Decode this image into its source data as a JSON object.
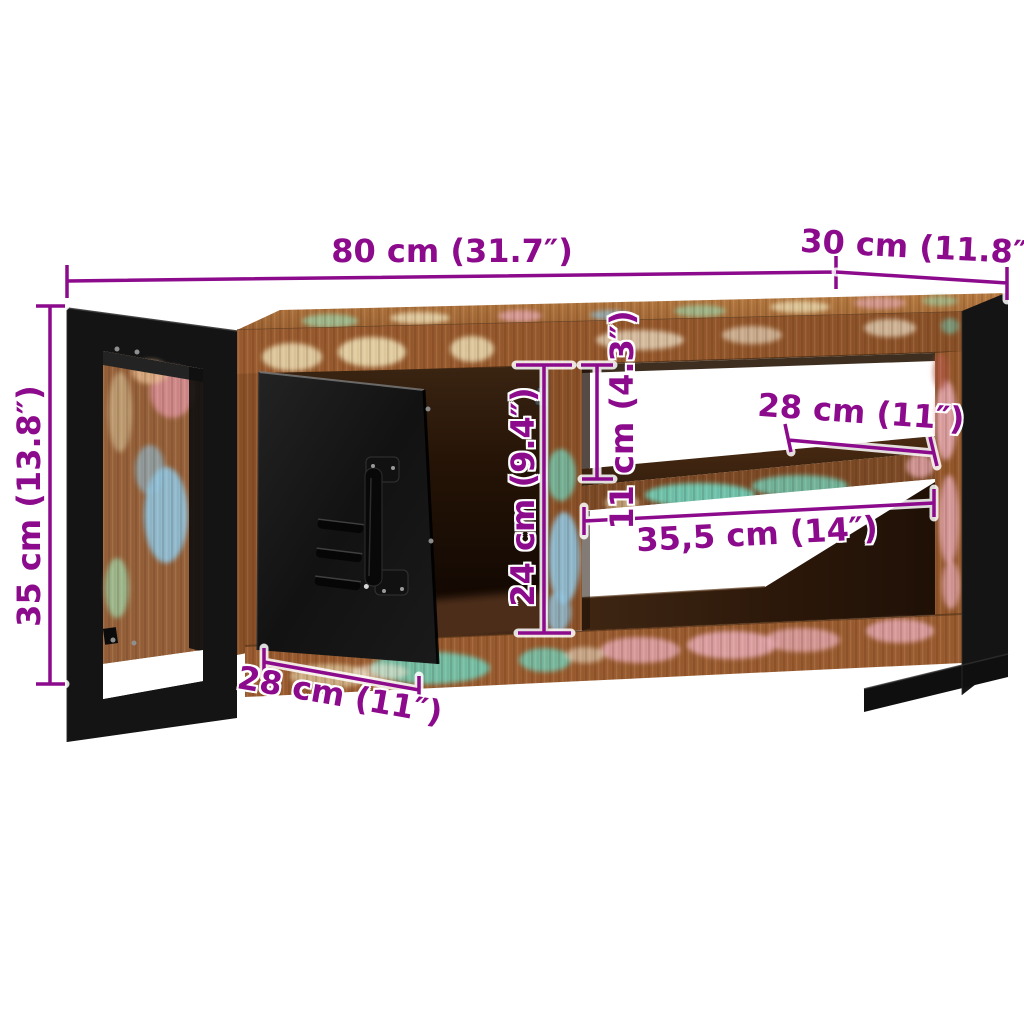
{
  "annotations": {
    "width": "80 cm (31.7″)",
    "depth": "30 cm (11.8″)",
    "height": "35 cm (13.8″)",
    "interior_height": "24 cm (9.4″)",
    "top_shelf_height": "11 cm (4.3″)",
    "shelf_depth": "28 cm (11″)",
    "shelf_width": "35,5 cm (14″)",
    "door_width": "28 cm (11″)"
  },
  "colors": {
    "dimension": "#8c0a8c",
    "halo": "#ffffff",
    "background": "#ffffff",
    "metal": "#141414",
    "wood": "#9a5c30",
    "wood_top": "#b5793f",
    "paint_teal": "#6fd0ba",
    "paint_pink": "#e3a6ae",
    "paint_blue": "#8fc3de",
    "paint_green": "#9dc79b",
    "paint_cream": "#e6d3a8"
  }
}
